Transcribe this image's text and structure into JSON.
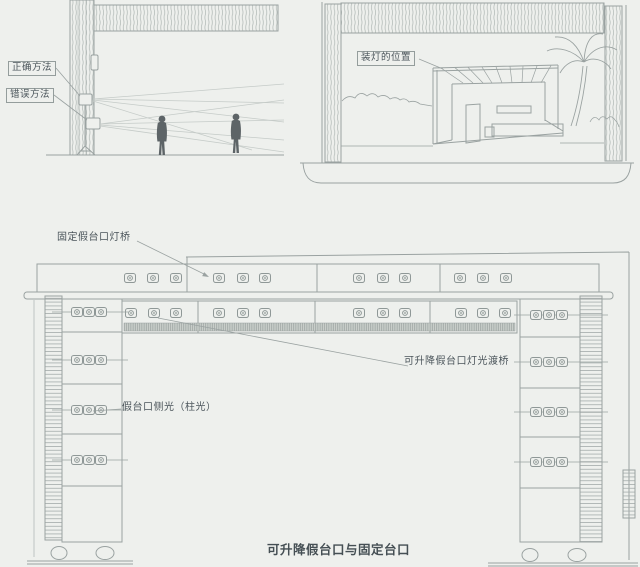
{
  "page": {
    "background_color": "#eef0ed",
    "line_color": "#9aa2a1",
    "text_color": "#4a545a",
    "figure_type": "stage lighting technical diagram"
  },
  "section_diagram": {
    "labels": {
      "correct_method": "正确方法",
      "wrong_method": "错误方法"
    }
  },
  "set_diagram": {
    "labels": {
      "mount_position": "装灯的位置"
    }
  },
  "proscenium_diagram": {
    "labels": {
      "fixed_bridge": "固定假台口灯桥",
      "lift_bridge": "可升降假台口灯光渡桥",
      "side_light": "假台口侧光（柱光）"
    },
    "caption": "可升降假台口与固定台口",
    "light_layout": {
      "upper_bridge_groups": 4,
      "lower_bridge_groups": 4,
      "lights_per_group": 3,
      "tower_light_rows": 4,
      "lights_per_row": 3
    }
  }
}
